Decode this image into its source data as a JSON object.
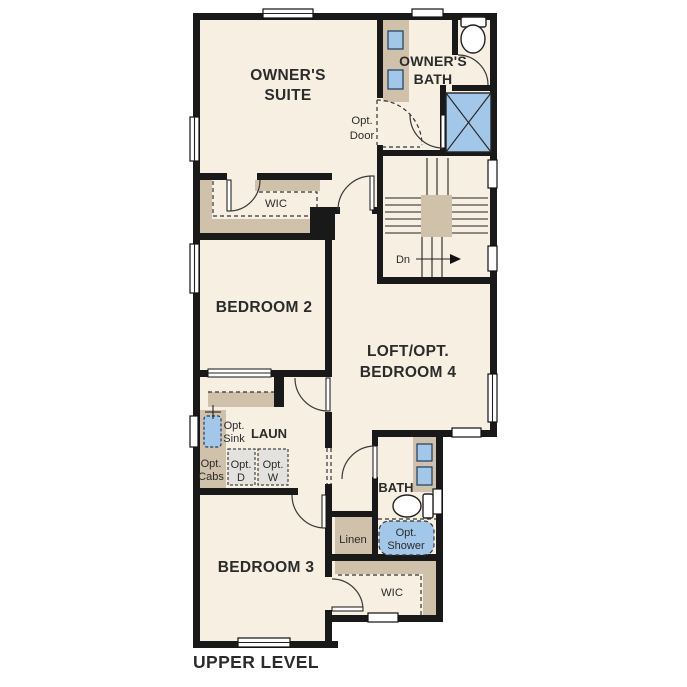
{
  "title": "UPPER LEVEL",
  "colors": {
    "background": "#ffffff",
    "floor": "#f6efe2",
    "wall": "#191919",
    "cabinet_tan": "#cfc1aa",
    "fixture_blue": "#a3c7e8",
    "appliance_gray": "#e3e2de",
    "text": "#2b2b2b"
  },
  "rooms": {
    "owners_suite": {
      "line1": "OWNER'S",
      "line2": "SUITE"
    },
    "owners_bath": {
      "line1": "OWNER'S",
      "line2": "BATH"
    },
    "opt_door": {
      "line1": "Opt.",
      "line2": "Door"
    },
    "wic_owner": "WIC",
    "stairs": {
      "down_label": "Dn"
    },
    "bedroom2": "BEDROOM 2",
    "loft": {
      "line1": "LOFT/OPT.",
      "line2": "BEDROOM 4"
    },
    "laundry": {
      "label": "LAUN",
      "opt_sink": {
        "line1": "Opt.",
        "line2": "Sink"
      },
      "opt_cabs": {
        "line1": "Opt.",
        "line2": "Cabs"
      },
      "opt_dryer": {
        "line1": "Opt.",
        "line2": "D"
      },
      "opt_washer": {
        "line1": "Opt.",
        "line2": "W"
      }
    },
    "bath2": "BATH",
    "linen": "Linen",
    "opt_shower": {
      "line1": "Opt.",
      "line2": "Shower"
    },
    "bedroom3": "BEDROOM 3",
    "wic_bedroom3": "WIC"
  }
}
